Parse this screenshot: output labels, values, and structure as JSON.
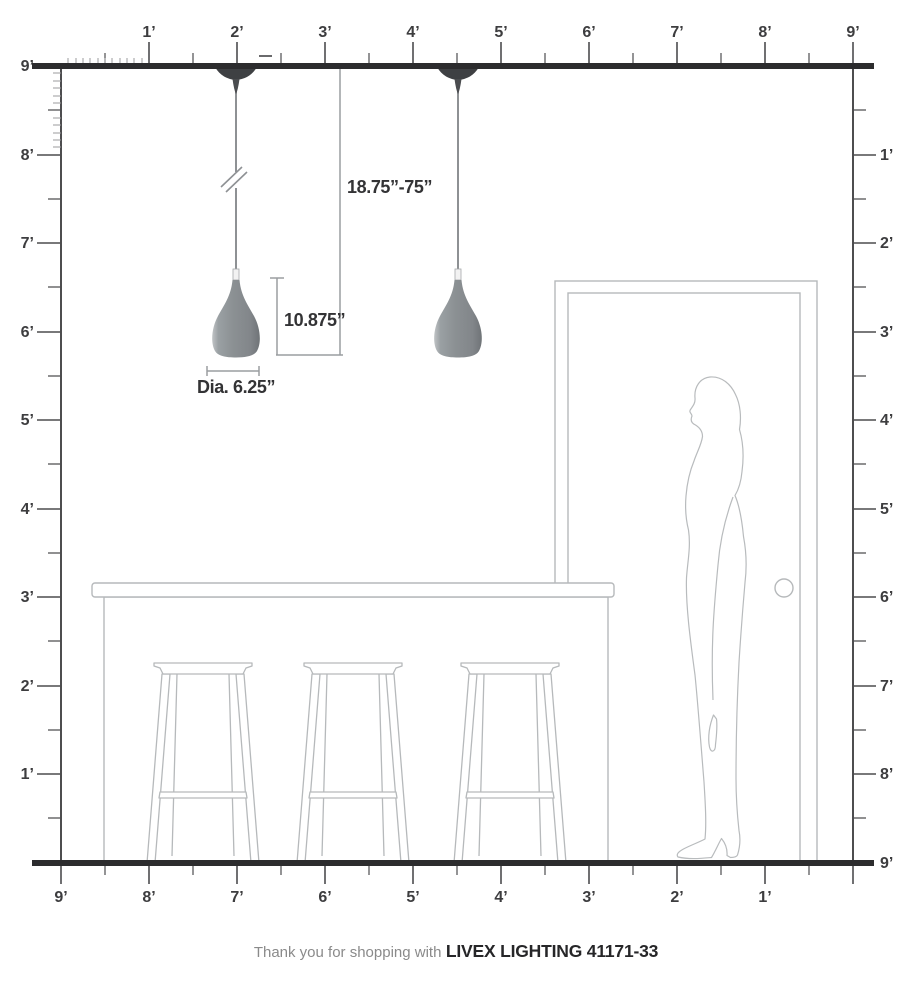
{
  "diagram": {
    "brand_line": {
      "prefix": "Thank you for shopping with",
      "brand": "LIVEX LIGHTING 41171-33"
    },
    "dimensions": {
      "hang_range": "18.75”-75”",
      "shade_height": "10.875”",
      "shade_diameter": "Dia. 6.25”"
    },
    "rulers": {
      "top": {
        "labels": [
          "1’",
          "2’",
          "3’",
          "4’",
          "5’",
          "6’",
          "7’",
          "8’",
          "9’"
        ]
      },
      "bottom": {
        "labels": [
          "9’",
          "8’",
          "7’",
          "6’",
          "5’",
          "4’",
          "3’",
          "2’",
          "1’"
        ]
      },
      "left": {
        "labels": [
          "9’",
          "8’",
          "7’",
          "6’",
          "5’",
          "4’",
          "3’",
          "2’",
          "1’"
        ]
      },
      "right": {
        "labels": [
          "1’",
          "2’",
          "3’",
          "4’",
          "5’",
          "6’",
          "7’",
          "8’",
          "9’"
        ]
      }
    },
    "colors": {
      "ceiling_floor": "#2c2c2e",
      "ruler_tick": "#4d4d4f",
      "furniture_outline": "#b6b9bb",
      "pendant_shade": "#8a8e90",
      "canopy": "#3e4043",
      "dimension_line": "#9a9da0",
      "label_text": "#3d3d3f"
    }
  }
}
